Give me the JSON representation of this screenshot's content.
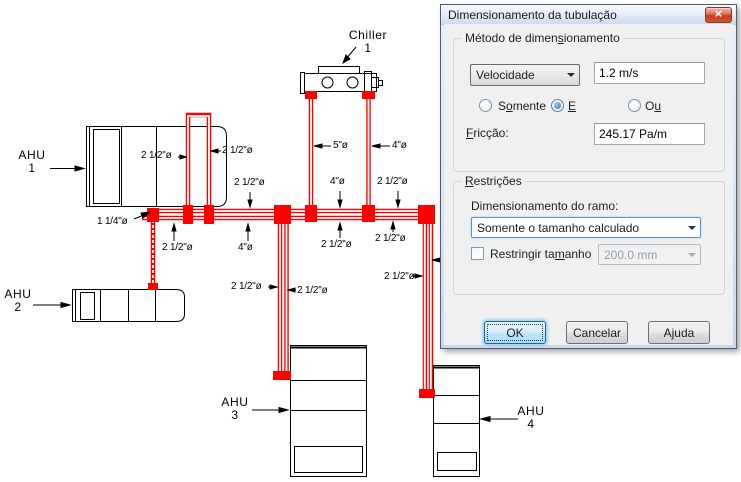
{
  "diagram": {
    "colors": {
      "pipe": "#ff0000",
      "line": "#000000"
    },
    "equipment_labels": {
      "chiller": {
        "line1": "Chiller",
        "line2": "1"
      },
      "ahu1": {
        "line1": "AHU",
        "line2": "1"
      },
      "ahu2": {
        "line1": "AHU",
        "line2": "2"
      },
      "ahu3": {
        "line1": "AHU",
        "line2": "3"
      },
      "ahu4": {
        "line1": "AHU",
        "line2": "4"
      }
    },
    "pipe_labels": [
      "2 1/2\"ø",
      "2 1/2\"ø",
      "5\"ø",
      "4\"ø",
      "2 1/2\"ø",
      "4\"ø",
      "2 1/2\"ø",
      "1 1/4\"ø",
      "2 1/2\"ø",
      "4\"ø",
      "2 1/2\"ø",
      "2 1/2\"ø",
      "2 1/2\"ø",
      "2 1/2\"ø",
      "2 1/2\"ø"
    ]
  },
  "dialog": {
    "title": "Dimensionamento da tubulação",
    "close_glyph": "×",
    "method_group": {
      "title_pre": "Método de dimen",
      "title_key": "s",
      "title_post": "ionamento",
      "method_value": "Velocidade",
      "velocity_value": "1.2 m/s",
      "radios": [
        {
          "pre": "S",
          "key": "o",
          "post": "mente",
          "selected": false
        },
        {
          "pre": "",
          "key": "E",
          "post": "",
          "selected": true
        },
        {
          "pre": "O",
          "key": "u",
          "post": "",
          "selected": false
        }
      ],
      "friction_pre": "",
      "friction_key": "F",
      "friction_post": "ricção:",
      "friction_value": "245.17 Pa/m"
    },
    "restrictions_group": {
      "title_pre": "",
      "title_key": "R",
      "title_post": "estrições",
      "branch_label": "Dimensionamento do ramo:",
      "branch_value": "Somente o tamanho calculado",
      "restrict_pre": "Restringir ta",
      "restrict_key": "m",
      "restrict_post": "anho",
      "restrict_checked": false,
      "size_value": "200.0 mm"
    },
    "buttons": {
      "ok": "OK",
      "cancel": "Cancelar",
      "help": "Ajuda"
    }
  }
}
